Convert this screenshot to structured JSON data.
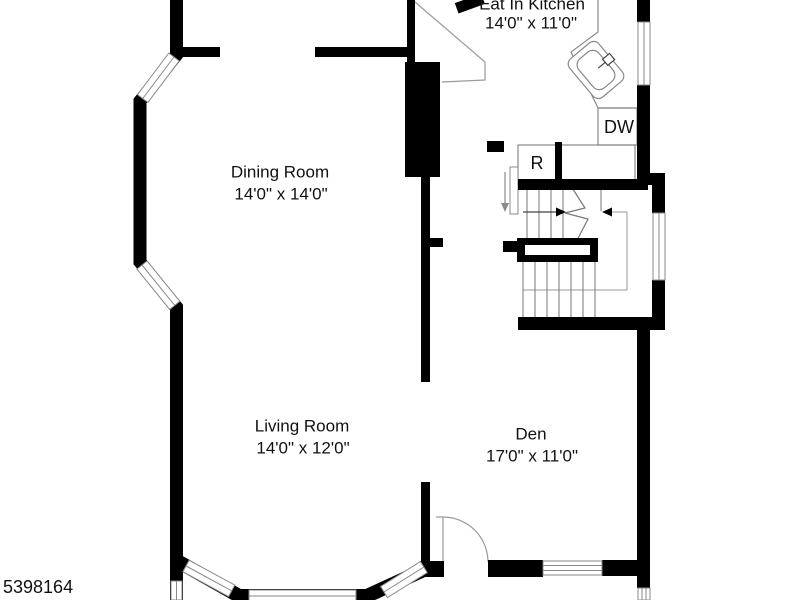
{
  "floorplan": {
    "listing_id": "5398164",
    "rooms": [
      {
        "name": "Eat In Kitchen",
        "dimensions": "14'0\" x 11'0\""
      },
      {
        "name": "Dining Room",
        "dimensions": "14'0\" x 14'0\""
      },
      {
        "name": "Living Room",
        "dimensions": "14'0\" x 12'0\""
      },
      {
        "name": "Den",
        "dimensions": "17'0\" x 11'0\""
      }
    ],
    "appliances": [
      {
        "label": "R"
      },
      {
        "label": "DW"
      }
    ],
    "icons": [
      "kitchen-sink-icon",
      "stair-up-arrow-icon",
      "door-swing-icon"
    ],
    "colors": {
      "wall": "#000000",
      "background": "#ffffff",
      "fixture_line": "#8a8a8a",
      "text": "#111111"
    }
  }
}
